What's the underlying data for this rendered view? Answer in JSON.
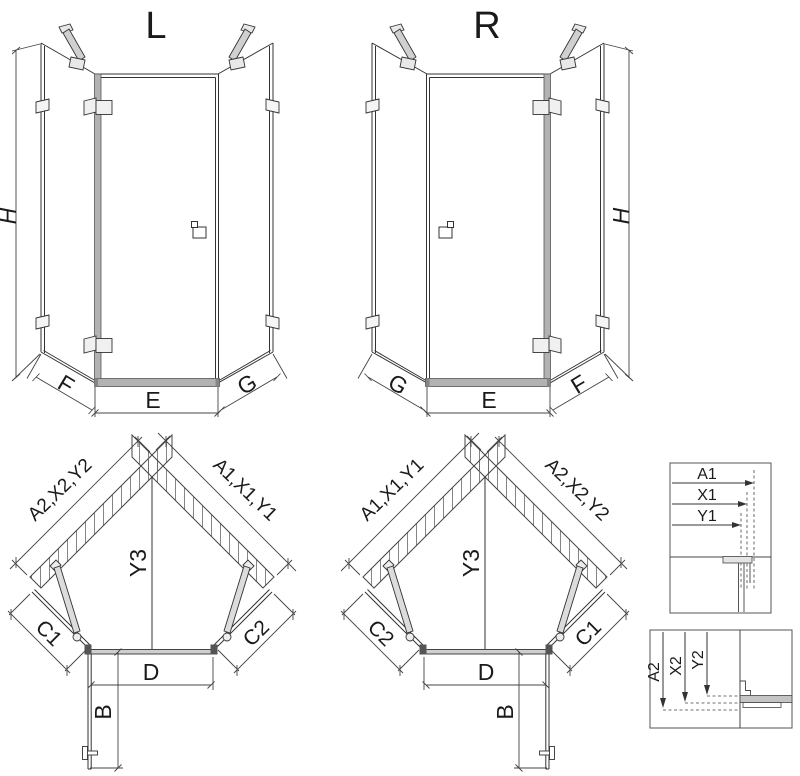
{
  "drawing": {
    "type": "shower-enclosure-technical-drawing",
    "views": {
      "front_left": {
        "title": "L",
        "dim_height": "H",
        "dim_panel_left": "F",
        "dim_door": "E",
        "dim_panel_right": "G"
      },
      "front_right": {
        "title": "R",
        "dim_height": "H",
        "dim_panel_left": "G",
        "dim_door": "E",
        "dim_panel_right": "F"
      },
      "plan_left": {
        "dim_wall_left": "A2,X2,Y2",
        "dim_wall_right": "A1,X1,Y1",
        "dim_depth": "Y3",
        "dim_side_left": "C1",
        "dim_side_right": "C2",
        "dim_door_width": "D",
        "dim_door_open": "B"
      },
      "plan_right": {
        "dim_wall_left": "A1,X1,Y1",
        "dim_wall_right": "A2,X2,Y2",
        "dim_depth": "Y3",
        "dim_side_left": "C2",
        "dim_side_right": "C1",
        "dim_door_width": "D",
        "dim_door_open": "B"
      },
      "detail_wall_profile": {
        "dims": [
          "A1",
          "X1",
          "Y1"
        ]
      },
      "detail_floor_profile": {
        "dims": [
          "A2",
          "X2",
          "Y2"
        ]
      }
    },
    "colors": {
      "line": "#333333",
      "dim_line": "#444444",
      "profile_gray": "#b2b2b2",
      "hardware_fill": "#f0f0f0",
      "hatch": "#666666",
      "text": "#1a1a1a",
      "background": "#ffffff"
    }
  }
}
